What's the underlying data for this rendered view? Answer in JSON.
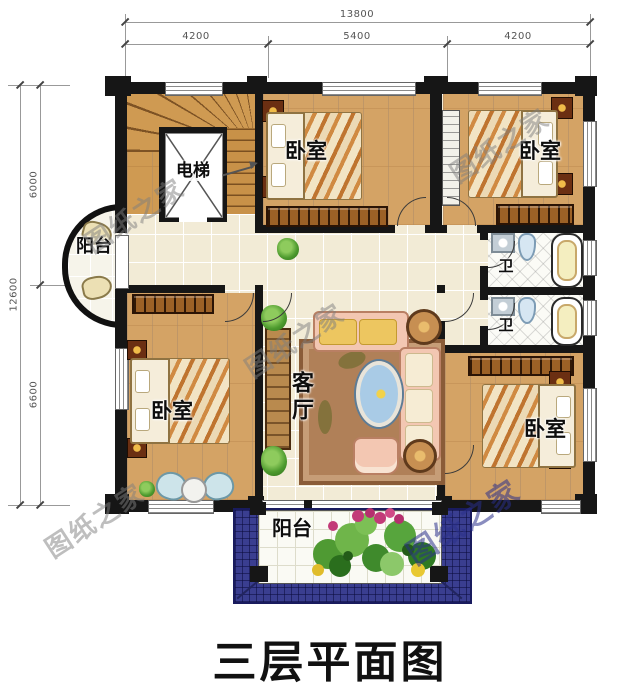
{
  "title": "三层平面图",
  "watermark_text": "图纸之家",
  "dimensions": {
    "top_total": "13800",
    "top_segments": [
      "4200",
      "5400",
      "4200"
    ],
    "left_total": "12600",
    "left_segments": [
      "6000",
      "6600"
    ]
  },
  "rooms": {
    "elevator": "电梯",
    "bedroom_top_middle": "卧室",
    "bedroom_top_right": "卧室",
    "bedroom_bottom_left": "卧室",
    "bedroom_bottom_right": "卧室",
    "living_room": "客厅",
    "bath_upper": "卫",
    "bath_lower": "卫",
    "balcony_left": "阳台",
    "balcony_bottom": "阳台"
  },
  "palette": {
    "wall": "#161616",
    "wood_floor": "#d4a365",
    "tile_floor": "#f2ebd6",
    "roof_blue": "#3a3e90",
    "sofa_pink": "#f3c7b2",
    "title_color": "#111111",
    "dimension_color": "#555555",
    "watermark_gray": "rgba(125,125,125,0.5)",
    "watermark_blue": "rgba(42,48,138,0.55)"
  }
}
